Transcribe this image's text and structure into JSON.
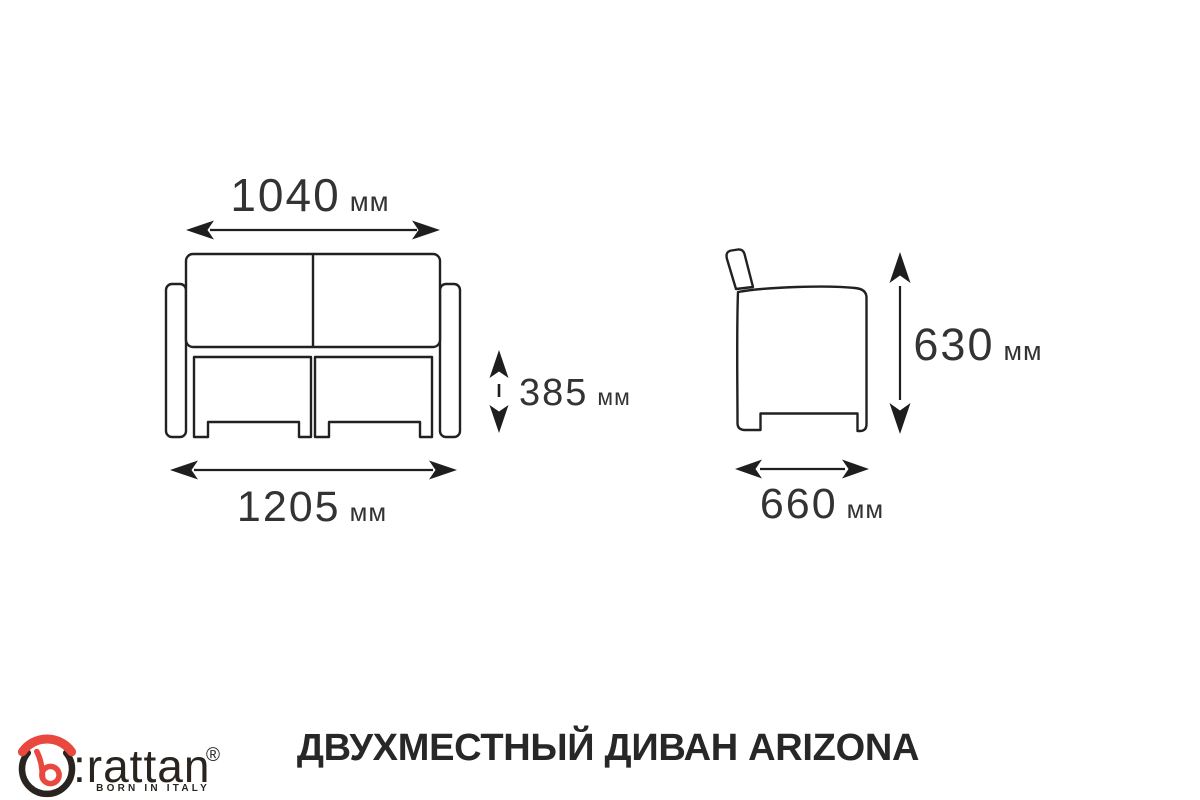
{
  "page": {
    "background": "#ffffff",
    "line_color": "#212121",
    "text_color": "#333333"
  },
  "dimensions": {
    "front_overall_width": {
      "value": "1040",
      "unit": "мм"
    },
    "front_seat_height": {
      "value": "385",
      "unit": "мм"
    },
    "front_base_width": {
      "value": "1205",
      "unit": "мм"
    },
    "side_height": {
      "value": "630",
      "unit": "мм"
    },
    "side_depth": {
      "value": "660",
      "unit": "мм"
    }
  },
  "footer": {
    "title": "ДВУХМЕСТНЫЙ ДИВАН ARIZONA",
    "logo": {
      "brand": ":rattan",
      "tagline": "BORN IN ITALY",
      "registered": "®",
      "accent_color": "#e8483d",
      "dark_color": "#29241f"
    }
  }
}
